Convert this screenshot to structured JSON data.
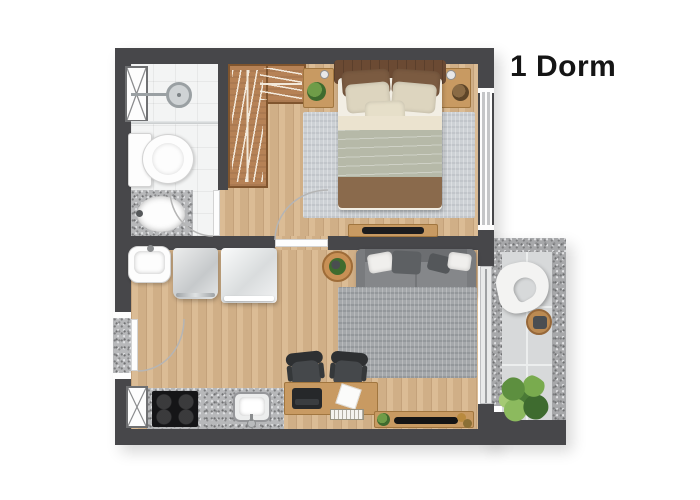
{
  "title": {
    "label": "1 Dorm"
  },
  "palette": {
    "wall": "#47474a",
    "wood_floor": "#d8b68c",
    "wardrobe_wood": "#b68256",
    "furniture_wood": "#c89a62",
    "granite": "#b7b8ba",
    "bath_tile": "#f3f4f4",
    "balcony_tile": "#d7d9da",
    "bedroom_rug": "#cdd1d5",
    "living_rug": "#a5a8ab",
    "sofa": "#85878a",
    "plant_green": "#5d8f3f",
    "text": "#151515"
  },
  "floor_plan": {
    "unit_type_label": "1 Dorm",
    "rooms": [
      {
        "name": "bathroom",
        "furniture": [
          "shower-head",
          "glass-partition",
          "toilet",
          "vanity-sink",
          "utility-shaft"
        ]
      },
      {
        "name": "closet",
        "furniture": [
          "l-shaped-wardrobe"
        ]
      },
      {
        "name": "bedroom",
        "furniture": [
          "double-bed",
          "nightstand-left",
          "nightstand-right",
          "area-rug",
          "tv-console",
          "window"
        ]
      },
      {
        "name": "living-kitchen",
        "furniture": [
          "laundry-tank",
          "washing-machine",
          "refrigerator",
          "sofa",
          "side-table",
          "area-rug",
          "office-desk",
          "office-chairs",
          "laptop",
          "books",
          "tv-sideboard",
          "kitchen-counter",
          "cooktop",
          "kitchen-sink",
          "utility-shaft",
          "entrance-door"
        ]
      },
      {
        "name": "balcony",
        "furniture": [
          "lounge-chair",
          "round-table",
          "large-plant",
          "sliding-glass-door"
        ]
      }
    ]
  }
}
